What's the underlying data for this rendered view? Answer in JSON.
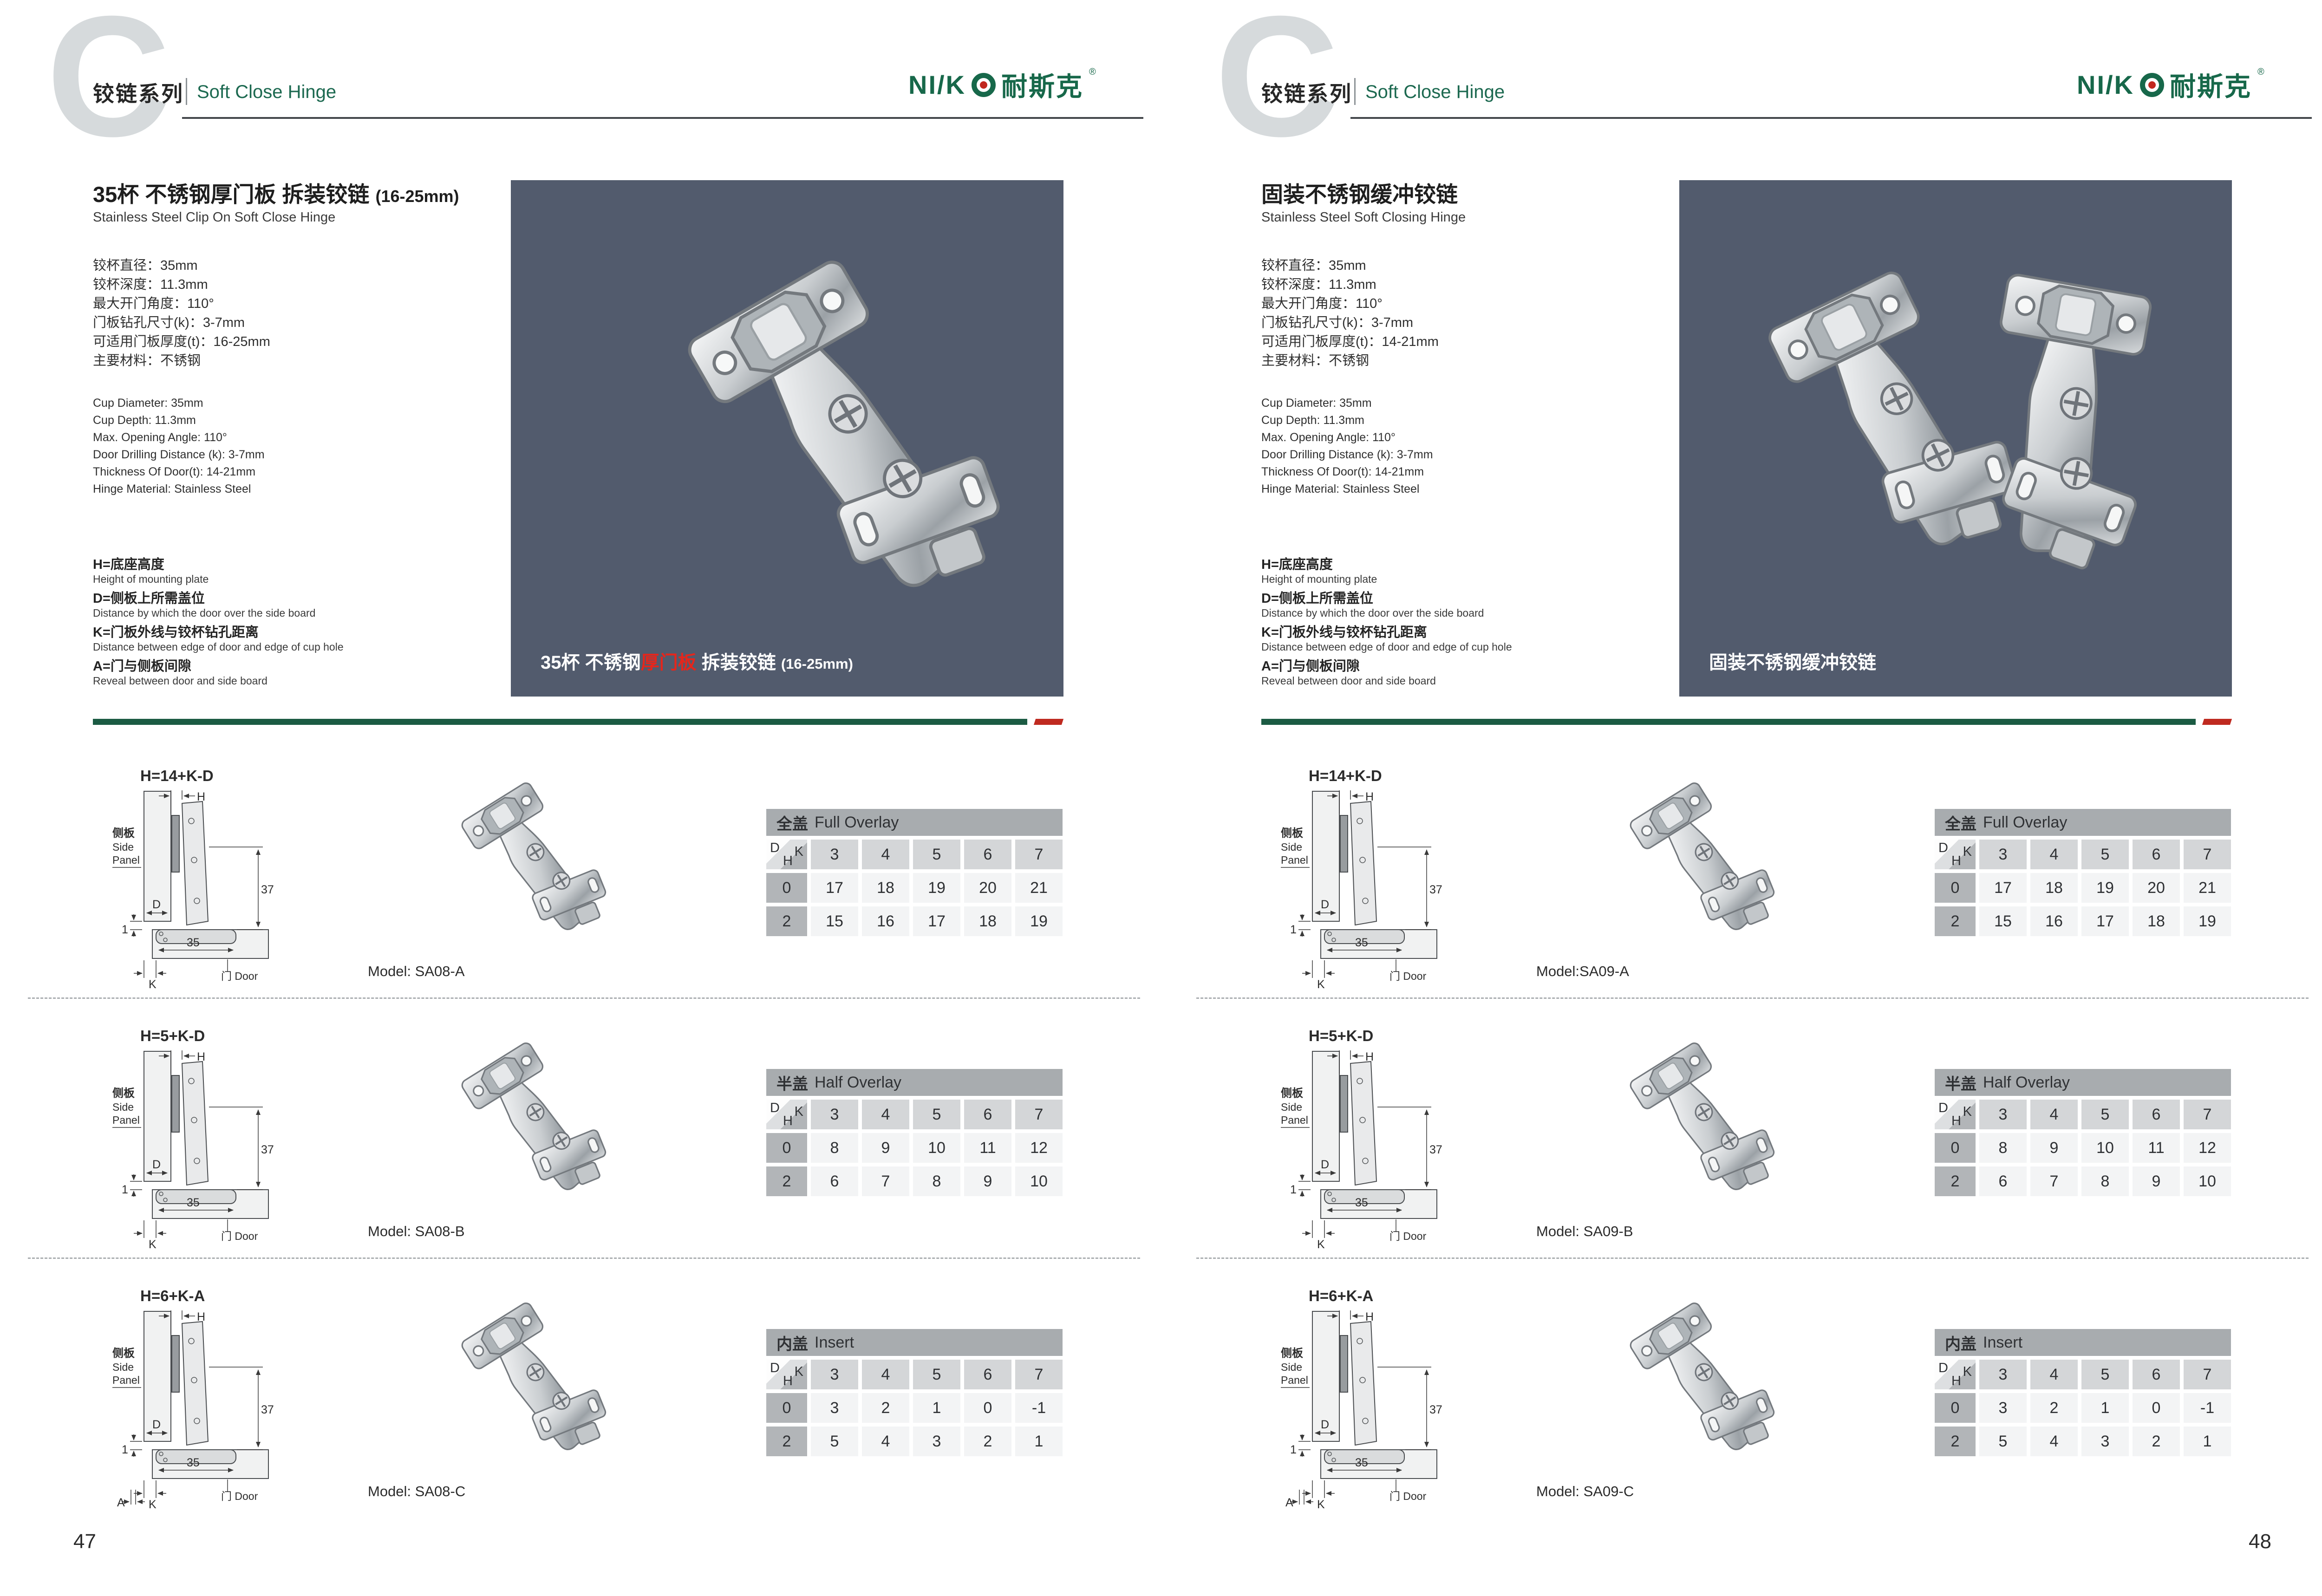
{
  "header": {
    "series_cn": "铰链系列",
    "series_en": "Soft Close Hinge",
    "watermark_letter": "C"
  },
  "logo": {
    "prefix": "NI/K",
    "cn": "耐斯克",
    "reg": "®"
  },
  "colors": {
    "accent_green": "#1B5B43",
    "english_green": "#1C6950",
    "accent_red": "#BF2A20",
    "photo_background": "#525B6D"
  },
  "diagram": {
    "h": "H",
    "d": "D",
    "k": "K",
    "a": "A",
    "one": "1",
    "cup_width": "35",
    "height_37": "37",
    "side_cn": "侧板",
    "side_en_1": "Side",
    "side_en_2": "Panel",
    "door": "门 Door"
  },
  "pages": [
    {
      "page_number": "47",
      "title_cn": "35杯 不锈钢厚门板 拆装铰链",
      "title_paren": "(16-25mm)",
      "title_en": "Stainless Steel Clip On Soft Close Hinge",
      "specs_cn": [
        "铰杯直径：35mm",
        "铰杯深度：11.3mm",
        "最大开门角度：110°",
        "门板钻孔尺寸(k)：3-7mm",
        "可适用门板厚度(t)：16-25mm",
        "主要材料：不锈钢"
      ],
      "specs_en": [
        "Cup Diameter: 35mm",
        "Cup Depth: 11.3mm",
        "Max. Opening Angle: 110°",
        "Door Drilling Distance (k): 3-7mm",
        "Thickness Of Door(t): 14-21mm",
        "Hinge Material: Stainless Steel"
      ],
      "legend": [
        {
          "cn": "H=底座高度",
          "en": "Height of mounting plate"
        },
        {
          "cn": "D=侧板上所需盖位",
          "en": "Distance by which the door over the side board"
        },
        {
          "cn": "K=门板外线与铰杯钻孔距离",
          "en": "Distance between edge of door and edge of cup hole"
        },
        {
          "cn": "A=门与侧板间隙",
          "en": "Reveal between door and side board"
        }
      ],
      "photo_caption": {
        "pre": "35杯 不锈钢",
        "red": "厚门板",
        "post": " 拆装铰链 ",
        "paren": "(16-25mm)"
      },
      "rows": [
        {
          "formula": "H=14+K-D",
          "model": "Model: SA08-A",
          "show_a": false,
          "table": {
            "title_cn": "全盖",
            "title_en": "Full Overlay",
            "k_values": [
              "3",
              "4",
              "5",
              "6",
              "7"
            ],
            "rows": [
              {
                "h": "0",
                "values": [
                  "17",
                  "18",
                  "19",
                  "20",
                  "21"
                ]
              },
              {
                "h": "2",
                "values": [
                  "15",
                  "16",
                  "17",
                  "18",
                  "19"
                ]
              }
            ]
          }
        },
        {
          "formula": "H=5+K-D",
          "model": "Model: SA08-B",
          "show_a": false,
          "table": {
            "title_cn": "半盖",
            "title_en": "Half Overlay",
            "k_values": [
              "3",
              "4",
              "5",
              "6",
              "7"
            ],
            "rows": [
              {
                "h": "0",
                "values": [
                  "8",
                  "9",
                  "10",
                  "11",
                  "12"
                ]
              },
              {
                "h": "2",
                "values": [
                  "6",
                  "7",
                  "8",
                  "9",
                  "10"
                ]
              }
            ]
          }
        },
        {
          "formula": "H=6+K-A",
          "model": "Model: SA08-C",
          "show_a": true,
          "table": {
            "title_cn": "内盖",
            "title_en": "Insert",
            "k_values": [
              "3",
              "4",
              "5",
              "6",
              "7"
            ],
            "rows": [
              {
                "h": "0",
                "values": [
                  "3",
                  "2",
                  "1",
                  "0",
                  "-1"
                ]
              },
              {
                "h": "2",
                "values": [
                  "5",
                  "4",
                  "3",
                  "2",
                  "1"
                ]
              }
            ]
          }
        }
      ]
    },
    {
      "page_number": "48",
      "title_cn": "固装不锈钢缓冲铰链",
      "title_paren": "",
      "title_en": "Stainless Steel Soft Closing Hinge",
      "specs_cn": [
        "铰杯直径：35mm",
        "铰杯深度：11.3mm",
        "最大开门角度：110°",
        "门板钻孔尺寸(k)：3-7mm",
        "可适用门板厚度(t)：14-21mm",
        "主要材料：不锈钢"
      ],
      "specs_en": [
        "Cup Diameter: 35mm",
        "Cup Depth: 11.3mm",
        "Max. Opening Angle: 110°",
        "Door Drilling Distance (k): 3-7mm",
        "Thickness Of Door(t): 14-21mm",
        "Hinge Material: Stainless Steel"
      ],
      "legend": [
        {
          "cn": "H=底座高度",
          "en": "Height of mounting plate"
        },
        {
          "cn": "D=侧板上所需盖位",
          "en": "Distance by which the door over the side board"
        },
        {
          "cn": "K=门板外线与铰杯钻孔距离",
          "en": "Distance between edge of door and edge of cup hole"
        },
        {
          "cn": "A=门与侧板间隙",
          "en": "Reveal between door and side board"
        }
      ],
      "photo_caption": {
        "pre": "固装不锈钢缓冲铰链",
        "red": "",
        "post": "",
        "paren": ""
      },
      "rows": [
        {
          "formula": "H=14+K-D",
          "model": "Model:SA09-A",
          "show_a": false,
          "table": {
            "title_cn": "全盖",
            "title_en": "Full Overlay",
            "k_values": [
              "3",
              "4",
              "5",
              "6",
              "7"
            ],
            "rows": [
              {
                "h": "0",
                "values": [
                  "17",
                  "18",
                  "19",
                  "20",
                  "21"
                ]
              },
              {
                "h": "2",
                "values": [
                  "15",
                  "16",
                  "17",
                  "18",
                  "19"
                ]
              }
            ]
          }
        },
        {
          "formula": "H=5+K-D",
          "model": "Model: SA09-B",
          "show_a": false,
          "table": {
            "title_cn": "半盖",
            "title_en": "Half Overlay",
            "k_values": [
              "3",
              "4",
              "5",
              "6",
              "7"
            ],
            "rows": [
              {
                "h": "0",
                "values": [
                  "8",
                  "9",
                  "10",
                  "11",
                  "12"
                ]
              },
              {
                "h": "2",
                "values": [
                  "6",
                  "7",
                  "8",
                  "9",
                  "10"
                ]
              }
            ]
          }
        },
        {
          "formula": "H=6+K-A",
          "model": "Model: SA09-C",
          "show_a": true,
          "table": {
            "title_cn": "内盖",
            "title_en": "Insert",
            "k_values": [
              "3",
              "4",
              "5",
              "6",
              "7"
            ],
            "rows": [
              {
                "h": "0",
                "values": [
                  "3",
                  "2",
                  "1",
                  "0",
                  "-1"
                ]
              },
              {
                "h": "2",
                "values": [
                  "5",
                  "4",
                  "3",
                  "2",
                  "1"
                ]
              }
            ]
          }
        }
      ]
    }
  ]
}
